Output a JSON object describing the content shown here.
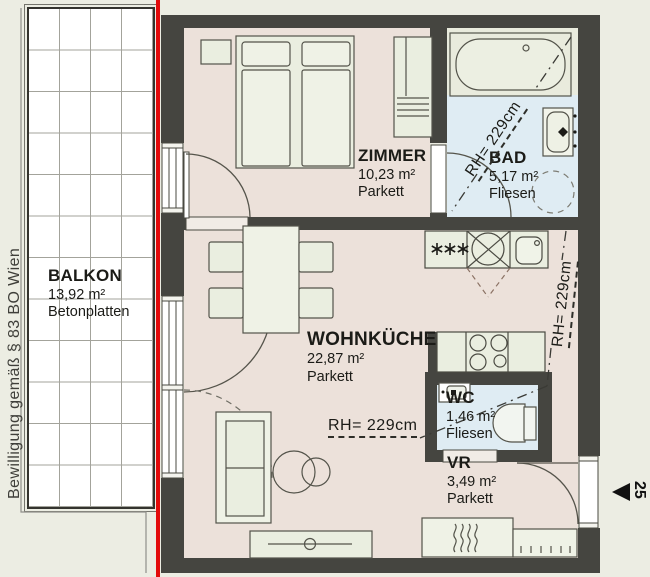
{
  "side_note": "Bewilligung gemäß § 83 BO Wien",
  "entrance": {
    "number": "25"
  },
  "rooms": {
    "balkon": {
      "name": "BALKON",
      "area": "13,92 m²",
      "floor": "Betonplatten"
    },
    "zimmer": {
      "name": "ZIMMER",
      "area": "10,23 m²",
      "floor": "Parkett"
    },
    "bad": {
      "name": "BAD",
      "area": "5,17 m²",
      "floor": "Fliesen"
    },
    "wohnkueche": {
      "name": "WOHNKÜCHE",
      "area": "22,87 m²",
      "floor": "Parkett"
    },
    "wc": {
      "name": "WC",
      "area": "1,46 m²",
      "floor": "Fliesen"
    },
    "vr": {
      "name": "VR",
      "area": "3,49 m²",
      "floor": "Parkett"
    }
  },
  "ceiling_heights": {
    "bad": "RH= 229cm",
    "corridor": "RH= 229cm",
    "wohnkueche": "RH= 229cm"
  },
  "colors": {
    "wall": "#454540",
    "parkett_floor": "#ece1da",
    "tile_floor": "#dfecf3",
    "furniture": "#eaeee0",
    "boundary_red": "#e30b0b",
    "background": "#ecede3"
  }
}
